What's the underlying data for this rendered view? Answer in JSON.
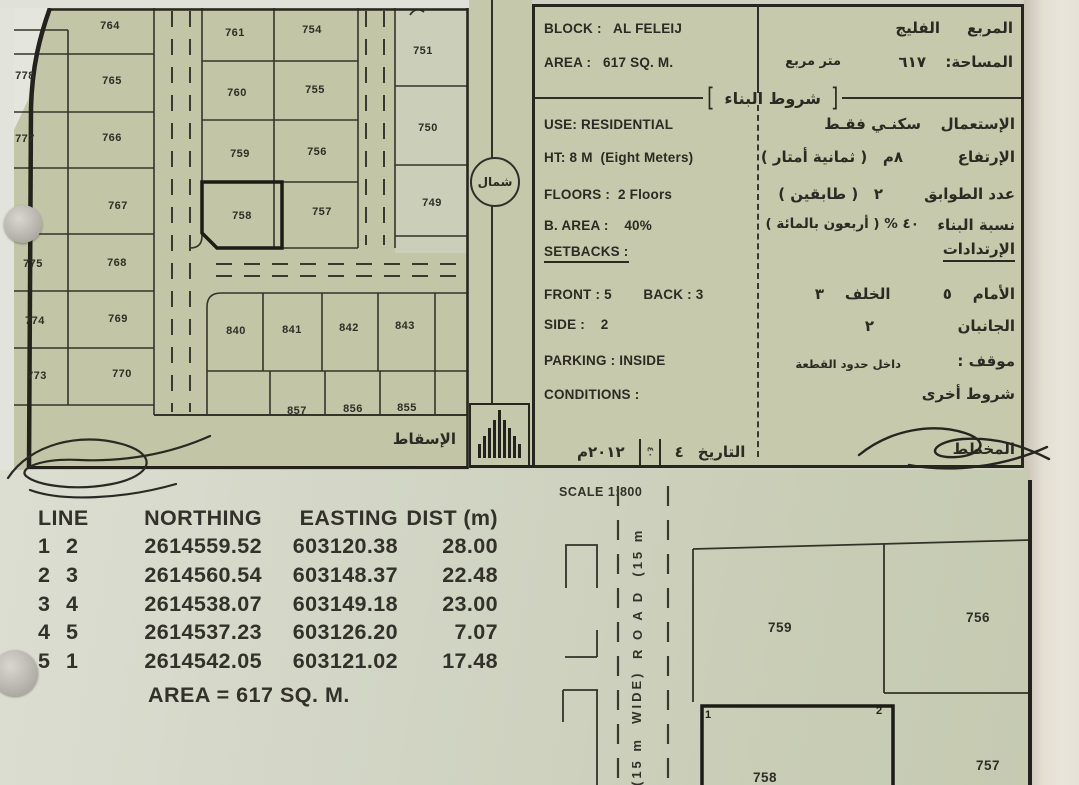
{
  "north": {
    "label": "شمال"
  },
  "map": {
    "projection_label": "الإسقاط",
    "projection_bars": [
      14,
      22,
      30,
      38,
      48,
      38,
      30,
      22,
      14
    ],
    "plots": [
      {
        "n": "778",
        "x": 11,
        "y": 67
      },
      {
        "n": "777",
        "x": 11,
        "y": 130
      },
      {
        "n": "775",
        "x": 19,
        "y": 255
      },
      {
        "n": "774",
        "x": 21,
        "y": 312
      },
      {
        "n": "773",
        "x": 23,
        "y": 367
      },
      {
        "n": "764",
        "x": 96,
        "y": 17
      },
      {
        "n": "765",
        "x": 98,
        "y": 72
      },
      {
        "n": "766",
        "x": 98,
        "y": 129
      },
      {
        "n": "767",
        "x": 104,
        "y": 197
      },
      {
        "n": "768",
        "x": 103,
        "y": 254
      },
      {
        "n": "769",
        "x": 104,
        "y": 310
      },
      {
        "n": "770",
        "x": 108,
        "y": 365
      },
      {
        "n": "761",
        "x": 221,
        "y": 24
      },
      {
        "n": "760",
        "x": 223,
        "y": 84
      },
      {
        "n": "759",
        "x": 226,
        "y": 145
      },
      {
        "n": "758",
        "x": 228,
        "y": 207,
        "bold": true
      },
      {
        "n": "754",
        "x": 298,
        "y": 21
      },
      {
        "n": "755",
        "x": 301,
        "y": 81
      },
      {
        "n": "756",
        "x": 303,
        "y": 143
      },
      {
        "n": "757",
        "x": 308,
        "y": 203
      },
      {
        "n": "751",
        "x": 409,
        "y": 42
      },
      {
        "n": "750",
        "x": 414,
        "y": 119
      },
      {
        "n": "749",
        "x": 418,
        "y": 194
      },
      {
        "n": "840",
        "x": 222,
        "y": 322
      },
      {
        "n": "841",
        "x": 278,
        "y": 321
      },
      {
        "n": "842",
        "x": 335,
        "y": 319
      },
      {
        "n": "843",
        "x": 391,
        "y": 317
      },
      {
        "n": "857",
        "x": 283,
        "y": 402
      },
      {
        "n": "856",
        "x": 339,
        "y": 400
      },
      {
        "n": "855",
        "x": 393,
        "y": 399
      }
    ]
  },
  "spec": {
    "partial_top_line": "القطعة : ٧٥٨",
    "block": {
      "en": "BLOCK :   AL FELEIJ",
      "value_ar": "الفليج",
      "label_ar": "المربع"
    },
    "area": {
      "en": "AREA :   617 SQ. M.",
      "value_ar": "٦١٧",
      "unit_ar": "متر مربع",
      "label_ar": "المساحة:"
    },
    "building_terms_header": "شروط البناء",
    "bracket_left": "[",
    "bracket_right": "]",
    "use": {
      "en": "USE: RESIDENTIAL",
      "value_ar": "سكنـي فقـط",
      "label_ar": "الإستعمال"
    },
    "height": {
      "en": "HT: 8 M  (Eight Meters)",
      "value_ar": "٨م   ( ثمانية أمتار )",
      "label_ar": "الإرتفاع"
    },
    "floors": {
      "en": "FLOORS :  2 Floors",
      "value_ar": "٢   ( طابقين )",
      "label_ar": "عدد الطوابق"
    },
    "b_area": {
      "en": "B. AREA :    40%",
      "value_ar": "٤٠ % ( أربعون بالمائة )",
      "label_ar": "نسبة البناء"
    },
    "setbacks_header": {
      "en": "SETBACKS :",
      "label_ar": "الإرتدادات"
    },
    "front_back": {
      "en": "FRONT : 5        BACK : 3",
      "value_ar": "الأمام    ٥          الخلف    ٣"
    },
    "side": {
      "en": "SIDE :    2",
      "value_ar": "الجانبان                ٢"
    },
    "parking": {
      "en": "PARKING : INSIDE",
      "value_ar": "داخل حدود القطعة",
      "label_ar": "موقف :"
    },
    "conditions": {
      "en": "CONDITIONS :",
      "label_ar": "شروط أخرى"
    },
    "date": {
      "label_ar": "التاريخ",
      "day": "٤",
      "stamp": "٤٠",
      "year": "٢٠١٢م"
    },
    "planner_label": "المخطط"
  },
  "survey_table": {
    "headers": [
      "LINE",
      "NORTHING",
      "EASTING",
      "DIST (m)"
    ],
    "rows": [
      [
        "1",
        "2",
        "2614559.52",
        "603120.38",
        "28.00"
      ],
      [
        "2",
        "3",
        "2614560.54",
        "603148.37",
        "22.48"
      ],
      [
        "3",
        "4",
        "2614538.07",
        "603149.18",
        "23.00"
      ],
      [
        "4",
        "5",
        "2614537.23",
        "603126.20",
        "7.07"
      ],
      [
        "5",
        "1",
        "2614542.05",
        "603121.02",
        "17.48"
      ]
    ],
    "area_total": "AREA = 617 SQ. M."
  },
  "detail_plan": {
    "scale_label": "SCALE 1:800",
    "road_label_upper": "R O A D  (15 m",
    "road_label_lower": "(15 m  WIDE)",
    "plots": [
      {
        "n": "759",
        "x": 250,
        "y": 148
      },
      {
        "n": "756",
        "x": 448,
        "y": 138
      },
      {
        "n": "758",
        "x": 235,
        "y": 298,
        "bold": true
      },
      {
        "n": "757",
        "x": 458,
        "y": 286
      }
    ],
    "corner_markers": [
      {
        "n": "1",
        "x": 178,
        "y": 238
      },
      {
        "n": "2",
        "x": 349,
        "y": 234
      }
    ]
  },
  "colors": {
    "ink": "#2c2b23",
    "line": "#34332a",
    "paper_map": "#c2c5a6",
    "paper_panel": "#c6c9ab",
    "margin": "#e4dfd3"
  }
}
